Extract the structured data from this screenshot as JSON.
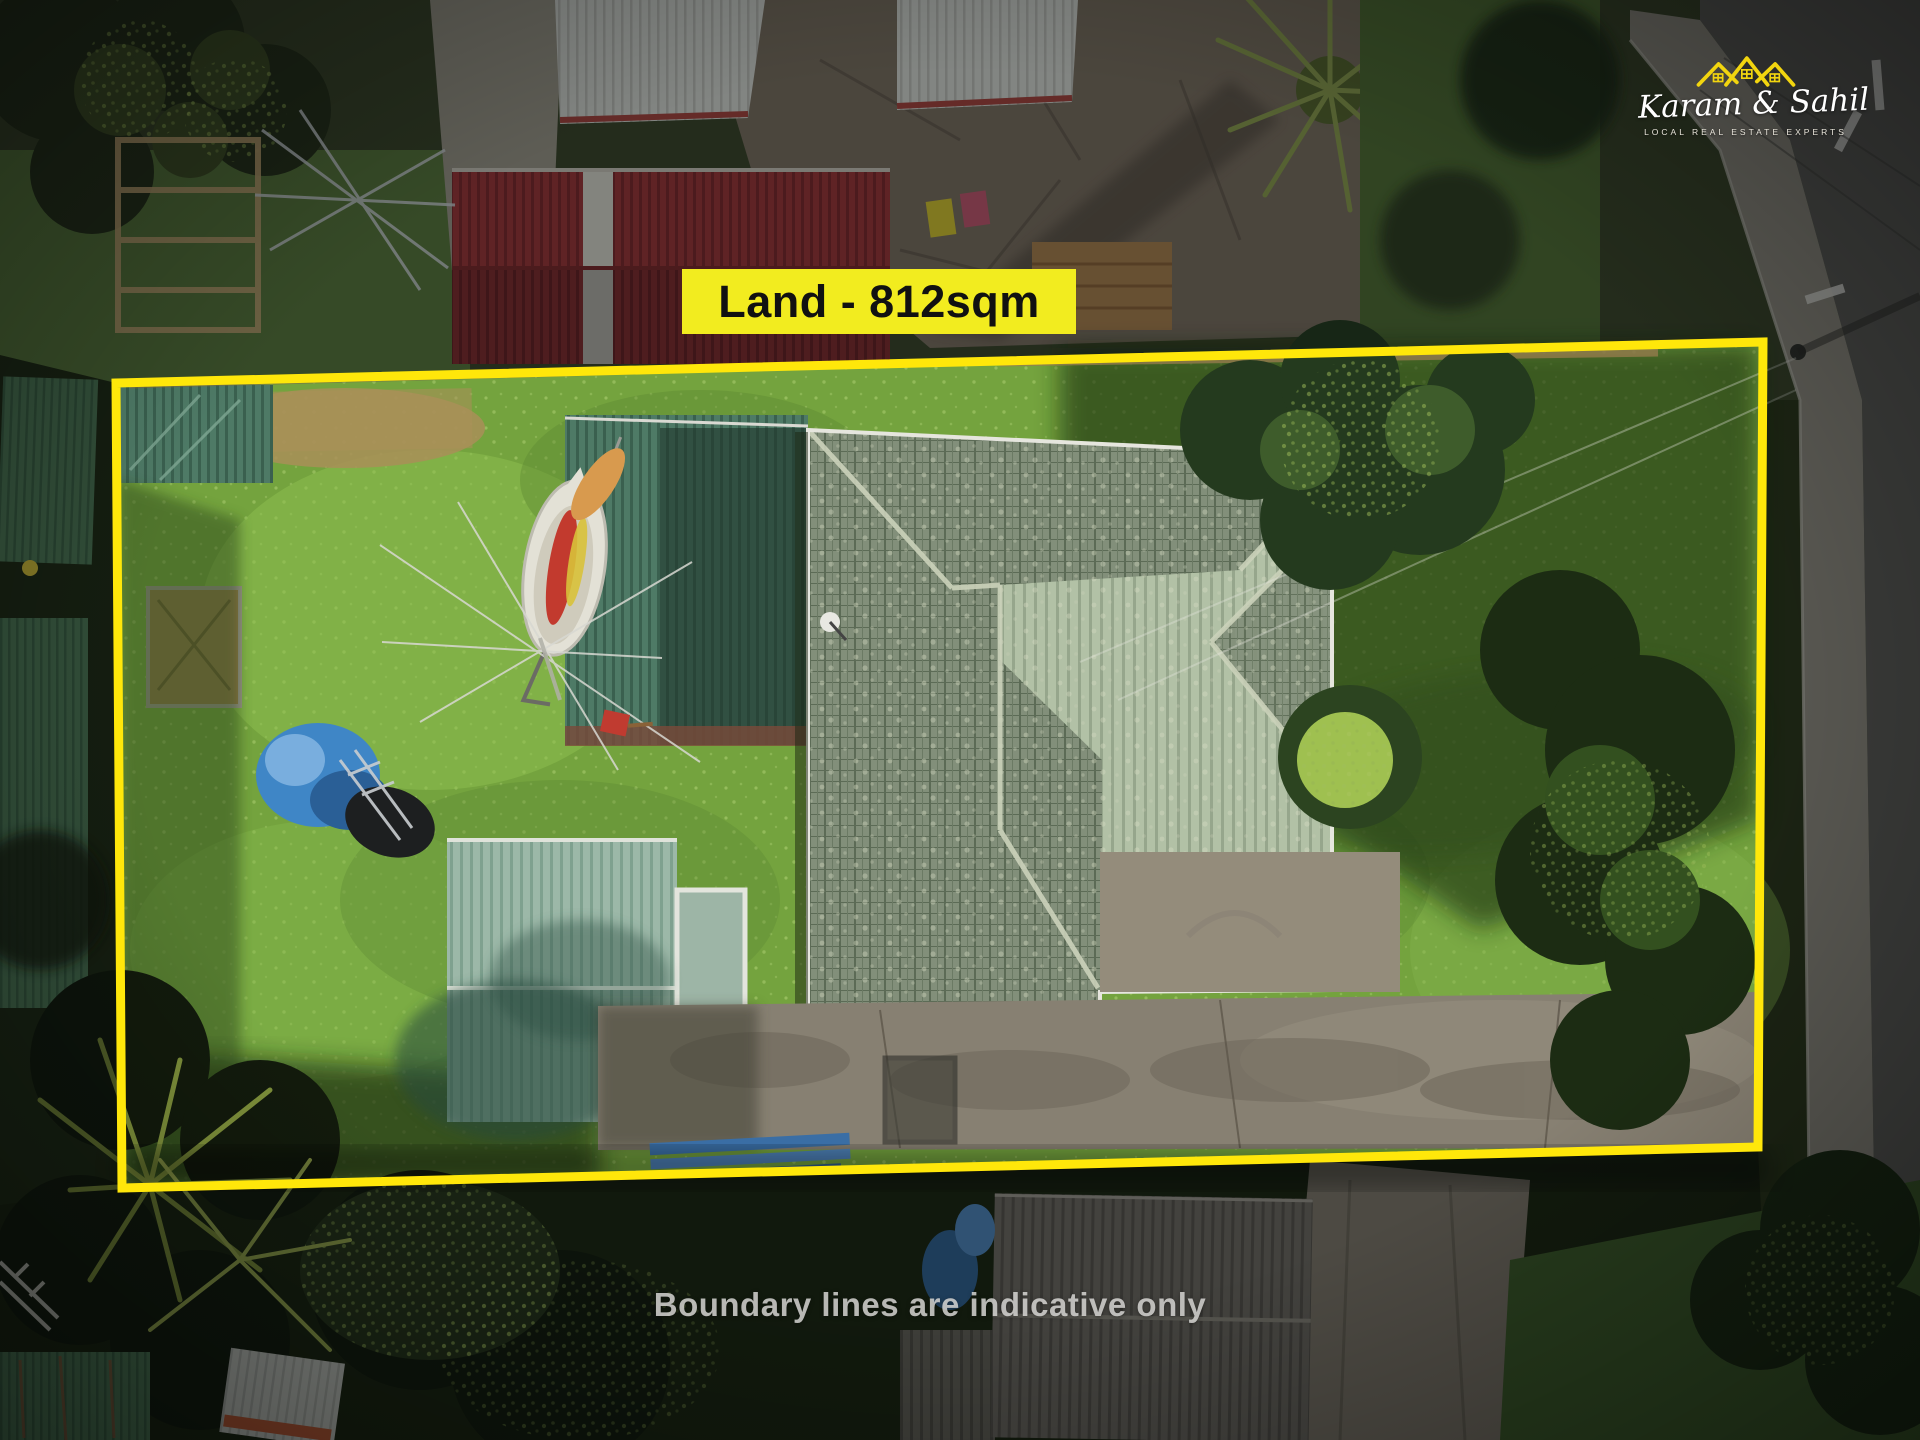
{
  "image": {
    "type": "aerial-property-listing-photo"
  },
  "annotations": {
    "land_label": "Land - 812sqm",
    "disclaimer": "Boundary lines are indicative only"
  },
  "logo": {
    "name": "Karam & Sahil",
    "tagline": "LOCAL REAL ESTATE EXPERTS",
    "icon": "triple-roof-icon",
    "accent_color": "#F2D50F",
    "text_color": "#FFFFFF"
  },
  "boundary": {
    "points": "116,383 1763,342 1758,1147 122,1188",
    "color": "#FFE70A",
    "stroke_width": "9",
    "label_background": "#F2EC1F",
    "label_text_color": "#111111"
  },
  "palette": {
    "lawn": "#74A33E",
    "lawn_light": "#8CBD4F",
    "main_roof_tiles": "#7E8F78",
    "main_roof_light": "#B0BFA3",
    "shed_roof": "#9CB8A8",
    "red_roof": "#9C3438",
    "driveway_concrete": "#878072",
    "road_asphalt": "#5D5B58",
    "footpath": "#8F8A80",
    "deep_shadow": "#16200F"
  }
}
